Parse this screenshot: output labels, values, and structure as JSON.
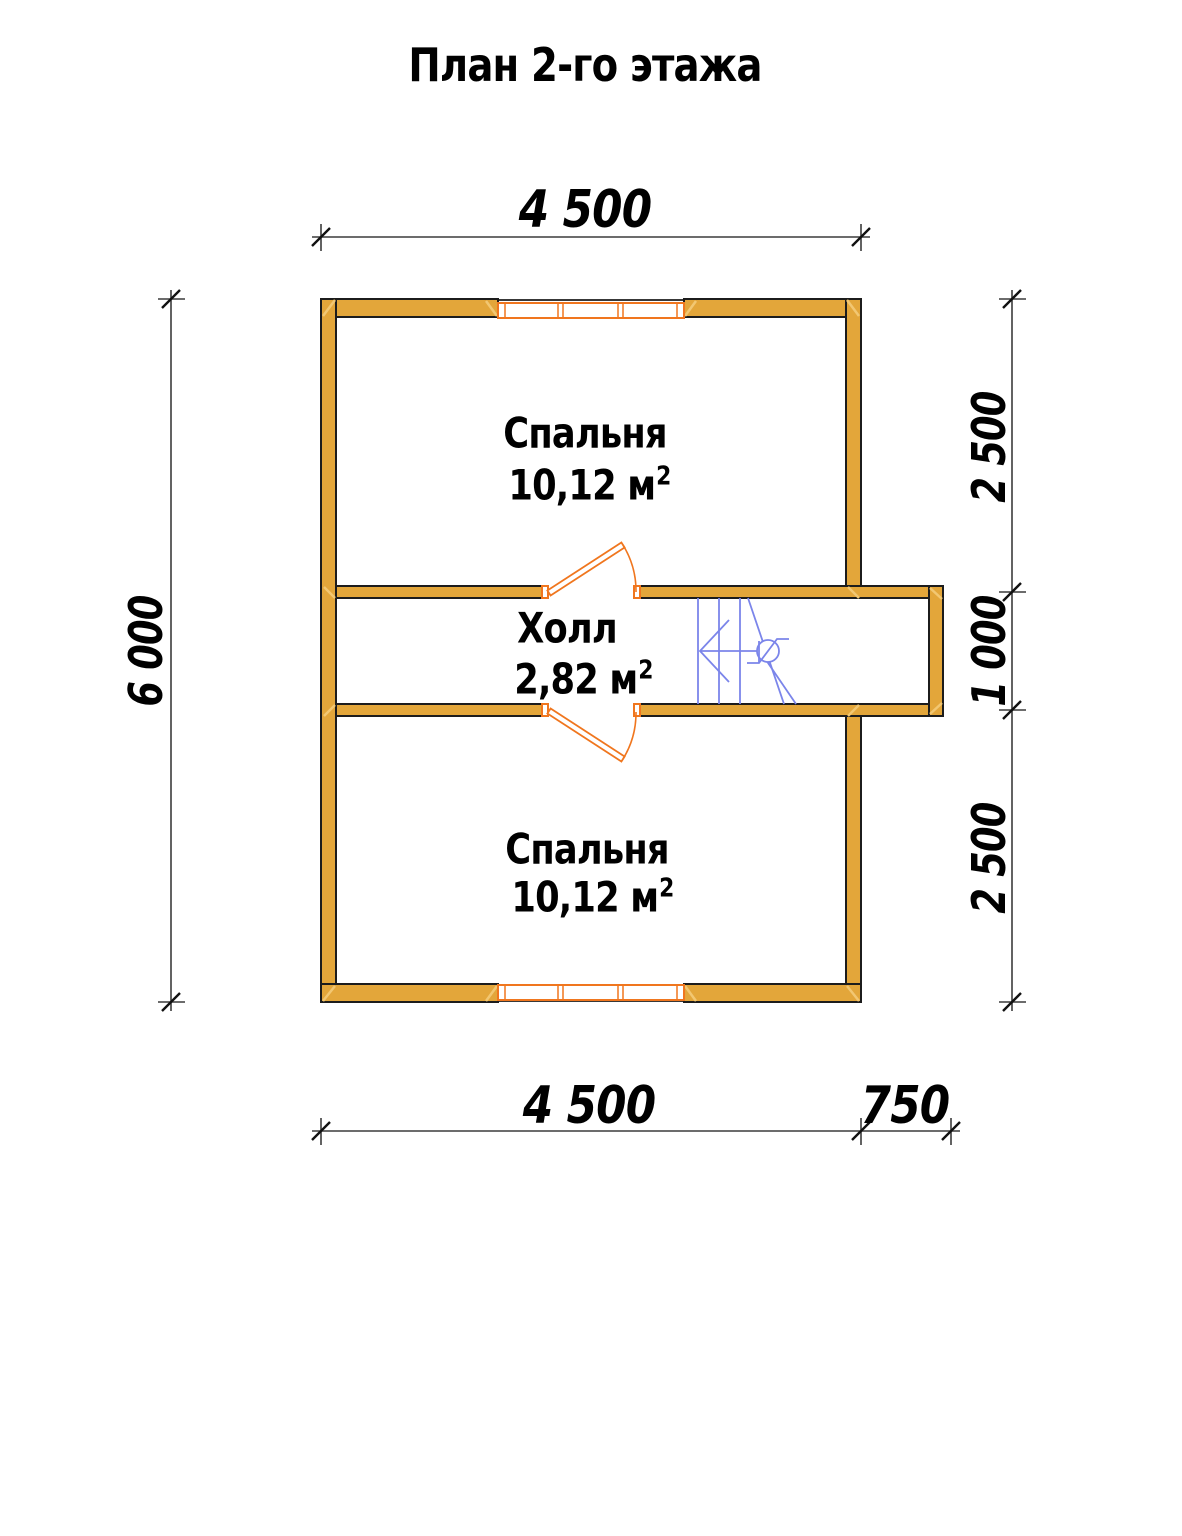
{
  "title": "План 2-го этажа",
  "plan": {
    "rooms": [
      {
        "id": "bedroom-top",
        "name": "Спальня",
        "area": "10,12 м",
        "area_sup": "2"
      },
      {
        "id": "hall",
        "name": "Холл",
        "area": "2,82 м",
        "area_sup": "2"
      },
      {
        "id": "bedroom-bottom",
        "name": "Спальня",
        "area": "10,12 м",
        "area_sup": "2"
      }
    ]
  },
  "dimensions": {
    "top_width": "4 500",
    "bottom_width": "4 500",
    "bottom_extension": "750",
    "left_height": "6 000",
    "right_top": "2 500",
    "right_middle": "1 000",
    "right_bottom": "2 500"
  },
  "colors": {
    "wall_fill": "#E3A63A",
    "wall_outline": "#1C1C1C",
    "joinery_orange": "#F0761E",
    "stairs_blue": "#7B85EA",
    "dimension_line": "#3C3C3C",
    "joint_mark": "#F2C772",
    "text": "#000000",
    "background": "#FFFFFF"
  }
}
